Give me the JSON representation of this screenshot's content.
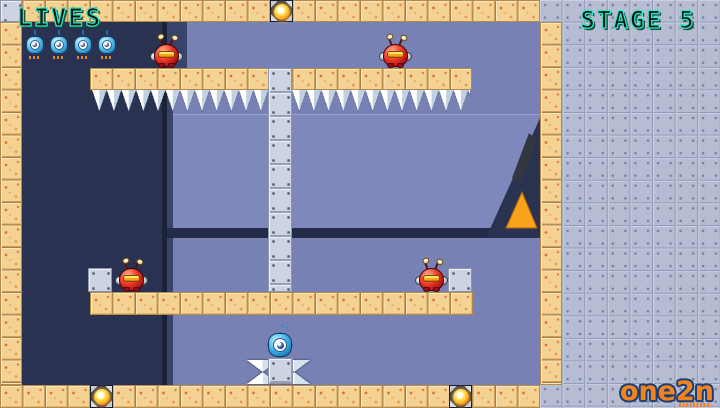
{
  "hud": {
    "lives_label": "LIVES",
    "stage_label": "STAGE 5",
    "lives_count": 4
  },
  "branding": {
    "logo_text": "one2n"
  },
  "entities": {
    "red_enemies_count": 4,
    "gold_orbs_count": 3,
    "player_creatures_count": 1
  },
  "colors": {
    "hud_accent_teal": "#33e6c6",
    "tile_tan": "#f4d294",
    "field_blue": "#7781b4",
    "dark_navy": "#2a3252",
    "side_panel_gray": "#b6bdd3",
    "enemy_red": "#ee3526",
    "orb_gold": "#ffb321",
    "hazard_orange": "#f9a21b",
    "logo_orange": "#f5831d"
  }
}
